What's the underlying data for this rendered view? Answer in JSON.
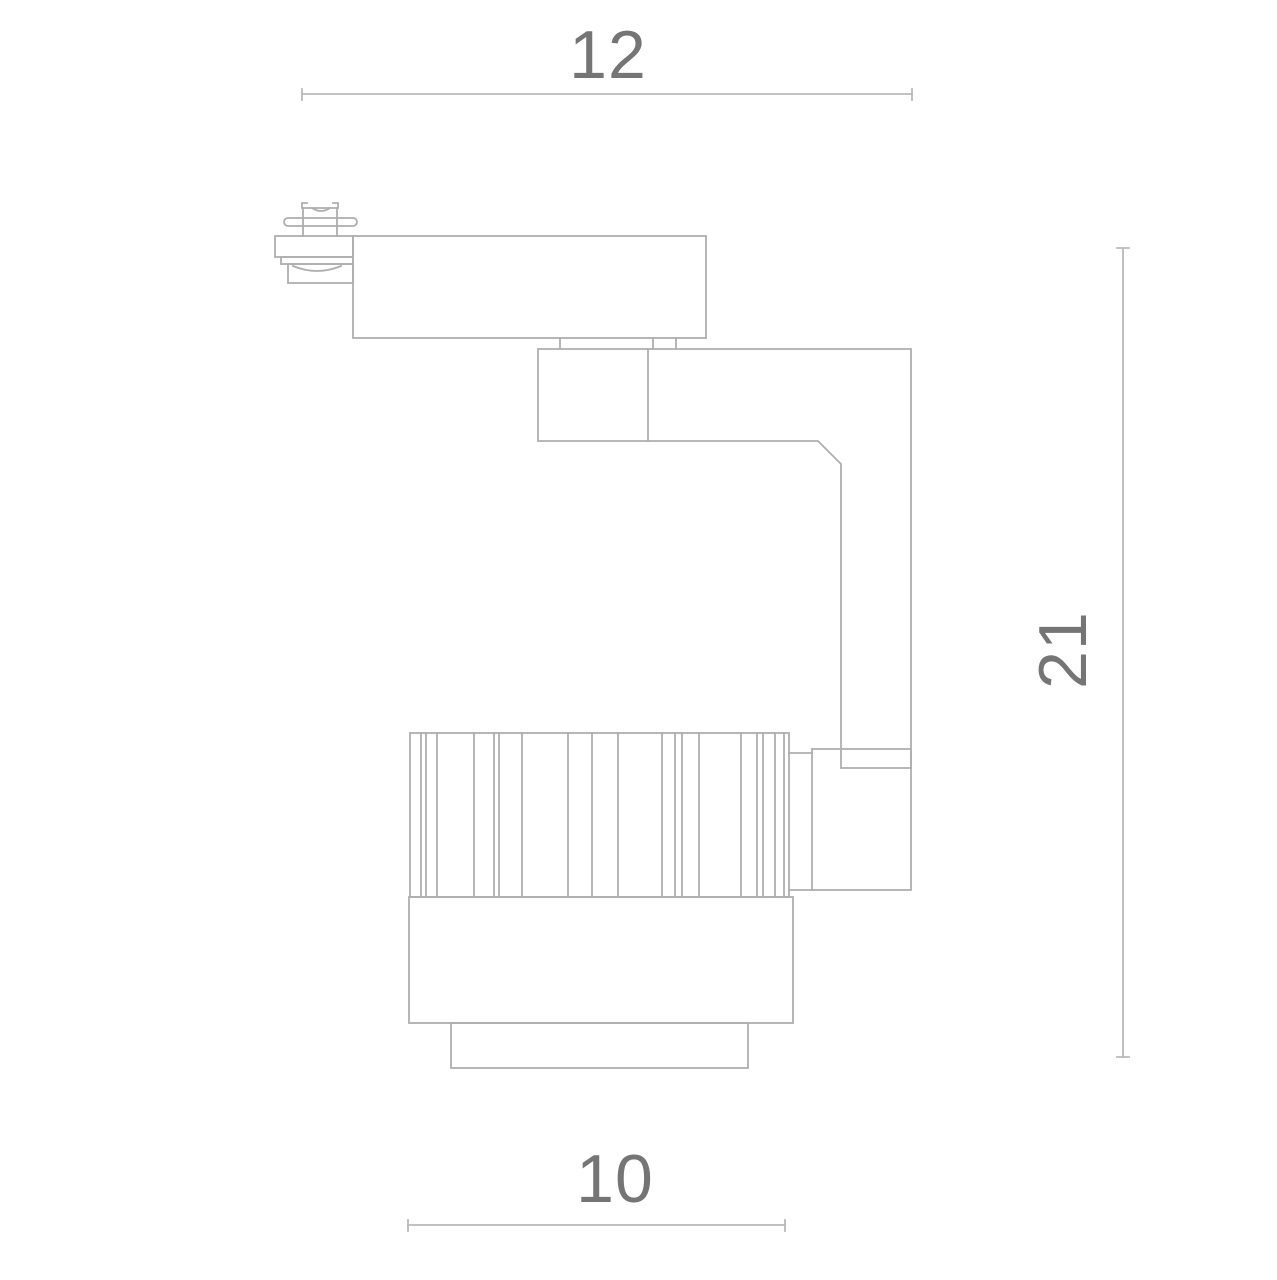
{
  "drawing": {
    "colors": {
      "background": "#ffffff",
      "line": "#aeaeae",
      "dimension": "#b9b9b9",
      "label": "#757575"
    },
    "dimension_labels": {
      "top_width": "12",
      "right_height": "21",
      "bottom_width": "10"
    }
  }
}
